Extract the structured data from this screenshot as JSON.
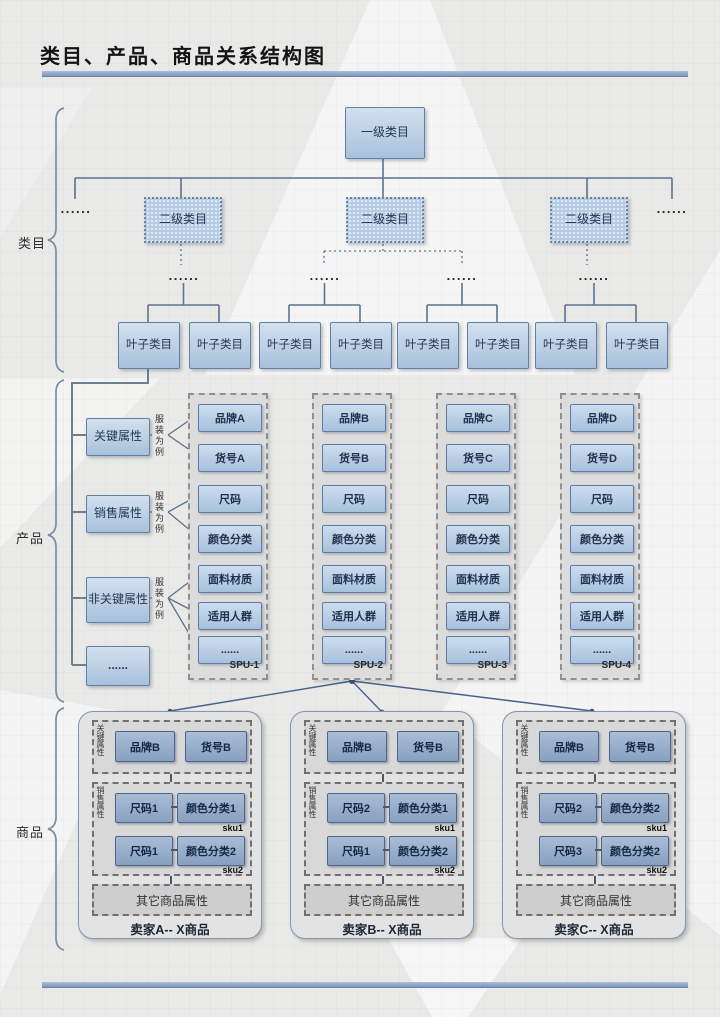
{
  "title": "类目、产品、商品关系结构图",
  "labels": {
    "catalog": "类目",
    "product": "产品",
    "goods": "商品"
  },
  "ellipsis": "......",
  "colors": {
    "box_blue": "#b9cde6",
    "accent_bar": "#8fa9cf",
    "line": "#5d7390",
    "dark_box_blue": "#8ca4c0"
  },
  "catalog": {
    "root": "一级类目",
    "level2": [
      "二级类目",
      "二级类目",
      "二级类目"
    ],
    "leaf": [
      "叶子类目",
      "叶子类目",
      "叶子类目",
      "叶子类目",
      "叶子类目",
      "叶子类目",
      "叶子类目",
      "叶子类目"
    ]
  },
  "product": {
    "attributes": [
      "关键属性",
      "销售属性",
      "非关键属性",
      "......"
    ],
    "example_note": "服装为例",
    "spu_columns": [
      {
        "label": "SPU-1",
        "items": [
          "品牌A",
          "货号A",
          "尺码",
          "颜色分类",
          "面料材质",
          "适用人群",
          "......"
        ]
      },
      {
        "label": "SPU-2",
        "items": [
          "品牌B",
          "货号B",
          "尺码",
          "颜色分类",
          "面料材质",
          "适用人群",
          "......"
        ]
      },
      {
        "label": "SPU-3",
        "items": [
          "品牌C",
          "货号C",
          "尺码",
          "颜色分类",
          "面料材质",
          "适用人群",
          "......"
        ]
      },
      {
        "label": "SPU-4",
        "items": [
          "品牌D",
          "货号D",
          "尺码",
          "颜色分类",
          "面料材质",
          "适用人群",
          "......"
        ]
      }
    ]
  },
  "goods": {
    "sellers": [
      {
        "label": "卖家A-- X商品",
        "key_attr_label": "关键属性",
        "sales_attr_label": "销售属性",
        "key_items": [
          "品牌B",
          "货号B"
        ],
        "other": "其它商品属性",
        "skus": [
          {
            "tag": "sku1",
            "size": "尺码1",
            "color": "颜色分类1"
          },
          {
            "tag": "sku2",
            "size": "尺码1",
            "color": "颜色分类2"
          }
        ]
      },
      {
        "label": "卖家B-- X商品",
        "key_attr_label": "关键属性",
        "sales_attr_label": "销售属性",
        "key_items": [
          "品牌B",
          "货号B"
        ],
        "other": "其它商品属性",
        "skus": [
          {
            "tag": "sku1",
            "size": "尺码2",
            "color": "颜色分类1"
          },
          {
            "tag": "sku2",
            "size": "尺码1",
            "color": "颜色分类2"
          }
        ]
      },
      {
        "label": "卖家C-- X商品",
        "key_attr_label": "关键属性",
        "sales_attr_label": "销售属性",
        "key_items": [
          "品牌B",
          "货号B"
        ],
        "other": "其它商品属性",
        "skus": [
          {
            "tag": "sku1",
            "size": "尺码2",
            "color": "颜色分类2"
          },
          {
            "tag": "sku2",
            "size": "尺码3",
            "color": "颜色分类2"
          }
        ]
      }
    ]
  }
}
